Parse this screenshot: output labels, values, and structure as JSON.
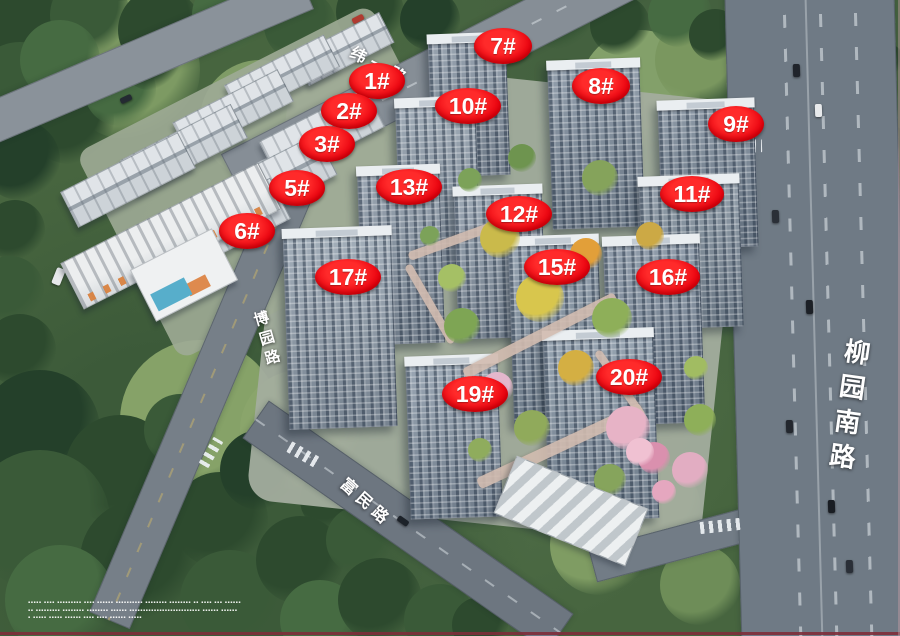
{
  "image": {
    "description": "Aerial 3D masterplan rendering of a residential compound with numbered building badges",
    "colors": {
      "label_bg": "#e8000d",
      "label_text": "#ffffff",
      "road_text": "#ffffff",
      "road_surface": "#6f7a85",
      "edge_line": "#7e2d3a"
    }
  },
  "building_labels": [
    {
      "text": "1#",
      "x": 377,
      "y": 81,
      "w": 56
    },
    {
      "text": "2#",
      "x": 349,
      "y": 111,
      "w": 56
    },
    {
      "text": "3#",
      "x": 327,
      "y": 144,
      "w": 56
    },
    {
      "text": "5#",
      "x": 297,
      "y": 188,
      "w": 56
    },
    {
      "text": "6#",
      "x": 247,
      "y": 231,
      "w": 56
    },
    {
      "text": "7#",
      "x": 503,
      "y": 46,
      "w": 58
    },
    {
      "text": "8#",
      "x": 601,
      "y": 86,
      "w": 58
    },
    {
      "text": "9#",
      "x": 736,
      "y": 124,
      "w": 56
    },
    {
      "text": "10#",
      "x": 468,
      "y": 106,
      "w": 66
    },
    {
      "text": "11#",
      "x": 692,
      "y": 194,
      "w": 64
    },
    {
      "text": "12#",
      "x": 519,
      "y": 214,
      "w": 66
    },
    {
      "text": "13#",
      "x": 409,
      "y": 187,
      "w": 66
    },
    {
      "text": "15#",
      "x": 557,
      "y": 267,
      "w": 66
    },
    {
      "text": "16#",
      "x": 668,
      "y": 277,
      "w": 64
    },
    {
      "text": "17#",
      "x": 348,
      "y": 277,
      "w": 66
    },
    {
      "text": "19#",
      "x": 475,
      "y": 394,
      "w": 66
    },
    {
      "text": "20#",
      "x": 629,
      "y": 377,
      "w": 66
    }
  ],
  "roads": [
    {
      "id": "weiyi",
      "name": "纬一路"
    },
    {
      "id": "boyuan",
      "name": "博园路"
    },
    {
      "id": "fumin",
      "name": "富民路"
    },
    {
      "id": "liuyuan",
      "name": "柳园南路"
    }
  ],
  "disclaimer_lines": [
    "▪▪▪▪▪ ▪▪▪▪ ▪▪▪▪▪▪▪▪▪ ▪▪▪▪ ▪▪▪▪▪▪ ▪▪▪▪▪▪▪▪▪▪ ▪▪▪▪▪▪▪▪ ▪▪▪▪▪▪▪▪ ▪▪ ▪▪▪▪ ▪▪▪ ▪▪▪▪▪▪",
    "▪▪ ▪▪▪▪▪▪▪▪▪ ▪▪▪▪▪▪▪▪ ▪▪▪▪▪▪▪▪ ▪▪▪▪▪▪ ▪▪▪▪▪▪▪▪▪▪▪▪▪▪▪▪▪▪▪▪▪▪▪▪▪▪ ▪▪▪▪▪▪ ▪▪▪▪▪▪",
    "▪ ▪▪▪▪▪ ▪▪▪▪▪ ▪▪▪▪▪▪ ▪▪▪▪ ▪▪▪▪ ▪▪▪▪▪▪ ▪▪▪▪▪"
  ]
}
